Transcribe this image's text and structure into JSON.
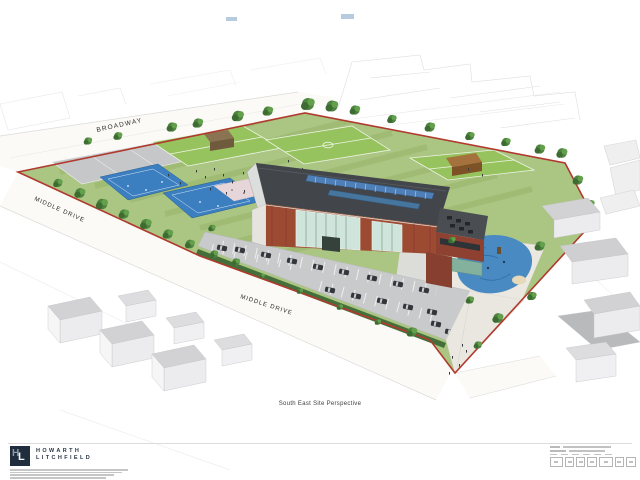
{
  "sheet": {
    "caption": "South East Site Perspective"
  },
  "drawing": {
    "street_labels": {
      "broadway": "BROADWAY",
      "middle_drive_left": "MIDDLE DRIVE",
      "middle_drive_bottom": "MIDDLE DRIVE"
    }
  },
  "footer": {
    "logo": {
      "letter_h": "H",
      "letter_l": "L"
    },
    "firm_name_line1": "HOWARTH",
    "firm_name_line2": "LITCHFIELD"
  },
  "colors": {
    "site_boundary_red": "#b03a2e",
    "grass_green": "#abc583",
    "pitch_green": "#96c35d",
    "court_blue": "#3b7fc0",
    "play_area_blue": "#4a8ac2",
    "brick_red": "#9d4a33",
    "roof_grey": "#42464b",
    "solar_panel_blue": "#4e7fb7",
    "parking_grey": "#c9cacb",
    "tree_green": "#4e8340",
    "logo_navy": "#1f2d3d"
  }
}
